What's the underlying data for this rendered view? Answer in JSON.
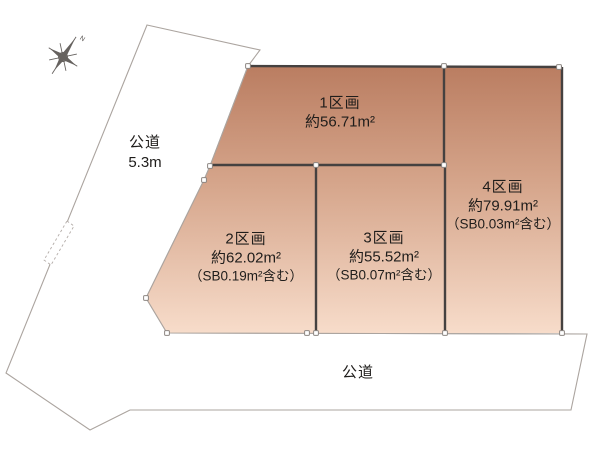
{
  "compass": {
    "north_label": "N"
  },
  "roads": {
    "left": {
      "name": "公道",
      "width_label": "5.3m"
    },
    "bottom": {
      "name": "公道"
    }
  },
  "parcels": [
    {
      "label": "1区画",
      "area": "約56.71m²",
      "sb": ""
    },
    {
      "label": "2区画",
      "area": "約62.02m²",
      "sb": "（SB0.19m²含む）"
    },
    {
      "label": "3区画",
      "area": "約55.52m²",
      "sb": "（SB0.07m²含む）"
    },
    {
      "label": "4区画",
      "area": "約79.91m²",
      "sb": "（SB0.03m²含む）"
    }
  ],
  "colors": {
    "parcel_top": "#ba7d61",
    "parcel_mid": "#d6a68c",
    "parcel_bottom": "#f7dcca",
    "road_fill": "#e1dcd9",
    "outline_light": "#aba49f",
    "boundary_dark": "#454140",
    "text": "#1f1d1b"
  }
}
